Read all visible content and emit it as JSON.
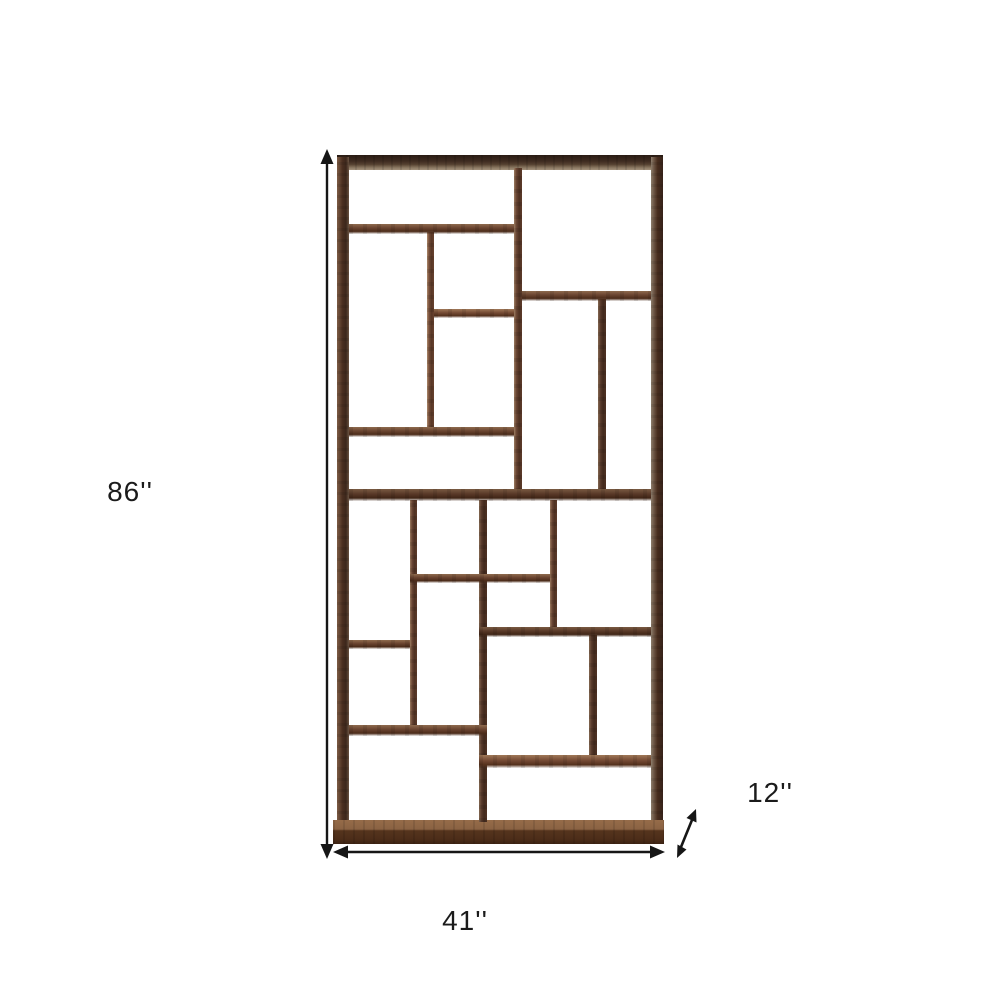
{
  "page": {
    "background": "#ffffff",
    "description": "Product dimension diagram of a dark-brown geometric cube bookcase with staggered asymmetric compartments"
  },
  "dimensions": {
    "height_label": "86''",
    "width_label": "41''",
    "depth_label": "12''"
  },
  "icons": {
    "height_arrow": "double-headed-vertical-arrow",
    "width_arrow": "double-headed-horizontal-arrow",
    "depth_arrow": "double-headed-diagonal-arrow"
  },
  "colors": {
    "annotation": "#1b1b1b",
    "wood_dark": "#46291a",
    "wood_mid": "#5f3c28",
    "wood_light": "#96846f",
    "background": "#ffffff"
  }
}
